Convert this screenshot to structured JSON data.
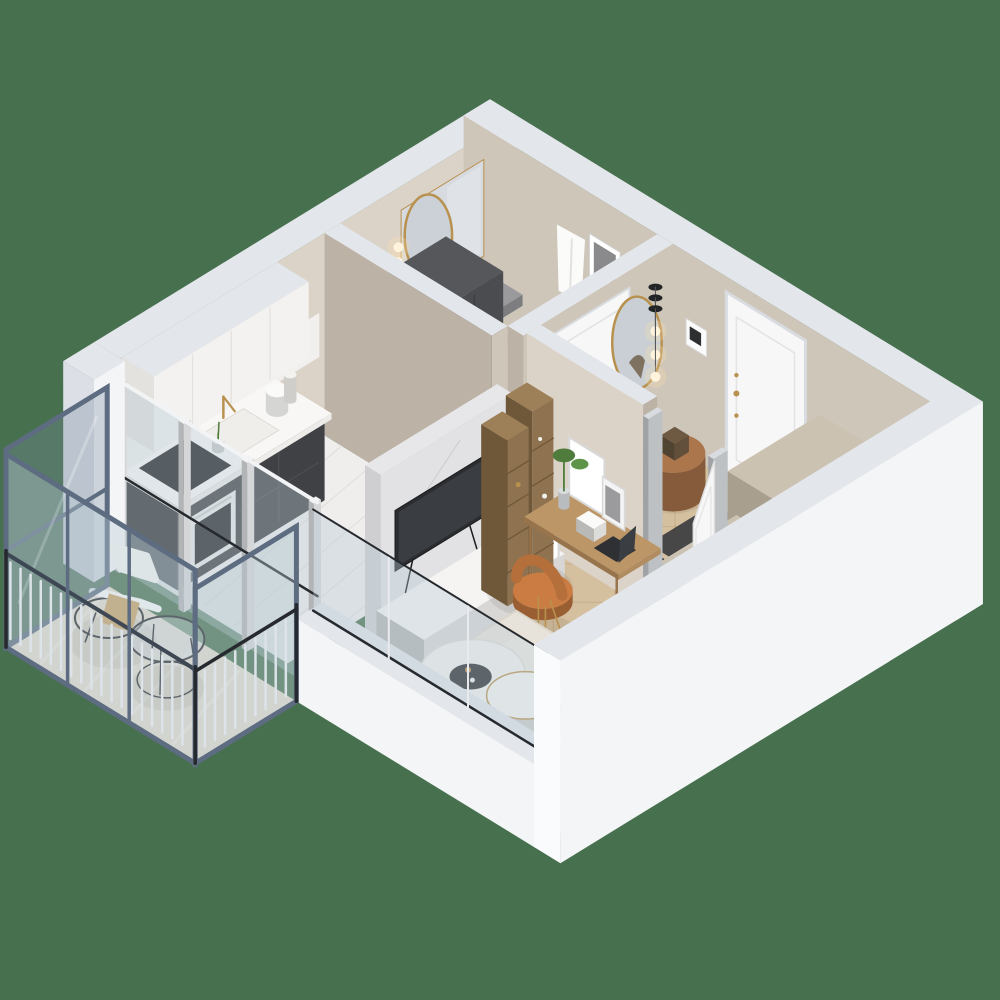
{
  "scene": {
    "type": "isometric-3d-floor-plan-render",
    "view": "axonometric-cutaway",
    "background_color": "#47714E",
    "palette": {
      "background": "#47714E",
      "outer_wall": "#F4F5F7",
      "outer_wall_shade": "#DCE0E6",
      "wall_top": "#E3E6EB",
      "wall_top_shade": "#CDD2DA",
      "inner_wall": "#CFC6BA",
      "inner_wall_light": "#DBD3C8",
      "inner_wall_dark": "#BCB2A5",
      "floor_wood": "#D4BF9F",
      "floor_wood_line": "#BB9F74",
      "floor_marble": "#EFEEEC",
      "marble_vein": "#DCDAD7",
      "bath_floor": "#E8E7E5",
      "balcony_floor": "#E2DACC",
      "cabinet_white": "#F3F2F0",
      "cabinet_white_shade": "#E4E2DE",
      "counter_white": "#F8F7F5",
      "kitchen_dark": "#3F4145",
      "kitchen_dark_shade": "#2F3134",
      "cooktop_black": "#1A1B1D",
      "oven_black": "#242628",
      "tall_cabinet": "#4A4C50",
      "tall_cabinet_shade": "#393B3F",
      "gold": "#B8914F",
      "marble_wall": "#DEDEE0",
      "tv_black": "#2B2D30",
      "bench_white": "#F5F4F2",
      "wood_shelf": "#8F7350",
      "wood_shelf_dark": "#6F5839",
      "desk_wood": "#B08C60",
      "desk_wood_dark": "#97744C",
      "chair_cognac": "#B46F3B",
      "door_white": "#F7F7F7",
      "door_shade": "#E9E9EA",
      "frame_gray": "#D8DBDF",
      "wardrobe_beige": "#C0B7A8",
      "wardrobe_beige_shade": "#A99F8F",
      "rug": "#E8E3DA",
      "rug_shade": "#DCD6CB",
      "sofa_cream": "#F0EBE1",
      "pillow_tan": "#C38D58",
      "pillow_brown": "#A66B3C",
      "pillow_gray": "#B9B1A7",
      "pillow_cream": "#E9E0D2",
      "pouf_brown": "#9C6B45",
      "mat_dark": "#3C3D3F",
      "balcony_frame": "#5D6C80",
      "balcony_frame_dark": "#3E4754",
      "rail_white": "#F2F3F5",
      "glass": "rgba(185,202,214,0.38)",
      "glass_dark": "rgba(120,140,160,0.32)",
      "plant_green": "#4F7C3C",
      "glow_warm": "#FFDFA8",
      "metal_black": "#26292D",
      "mirror_glass": "#D7DBDF",
      "gray_counter": "#8E8E90"
    },
    "rooms": [
      {
        "name": "bathroom",
        "furniture": [
          "vanity-counter",
          "vessel-basin",
          "gold-wall-faucet",
          "mirror-panel",
          "arched-gold-mirror",
          "wall-sconce",
          "tall-storage-cabinet",
          "bathtub",
          "hanging-towel",
          "framed-art",
          "gold-towel-ladder",
          "bathroom-door"
        ]
      },
      {
        "name": "kitchen",
        "furniture": [
          "upper-cabinets",
          "marble-backsplash",
          "countertop",
          "inset-sink",
          "gold-faucet",
          "induction-cooktop",
          "built-in-oven",
          "base-cabinets",
          "kettle",
          "paper-towel-roll",
          "flower-vase"
        ]
      },
      {
        "name": "hallway",
        "furniture": [
          "entrance-door",
          "intercom-panel",
          "oval-gold-mirror",
          "pendant-lights",
          "wooden-pouf",
          "handbag",
          "heeled-shoes",
          "doormat",
          "wardrobe-cabinet-large",
          "wardrobe-cabinet-small"
        ]
      },
      {
        "name": "living-room",
        "furniture": [
          "marble-tv-wall",
          "wall-mounted-tv",
          "media-bench",
          "leaning-picture-frame",
          "wooden-shelving-towers",
          "desk",
          "laptop",
          "desk-picture-frames",
          "desk-organizer",
          "desk-plant",
          "cognac-chair",
          "open-interior-door",
          "area-rug",
          "nesting-coffee-tables",
          "black-serving-tray",
          "gold-sphere-floor-lamp",
          "sofa",
          "sofa-cushions"
        ]
      },
      {
        "name": "balcony",
        "furniture": [
          "glazed-enclosure",
          "white-railing",
          "wire-lounge-chair",
          "seat-cushion",
          "tan-blanket",
          "wire-coffee-table",
          "glass-partition-door"
        ]
      }
    ],
    "structure": [
      "white-outer-walls",
      "greige-interior-partitions",
      "herringbone-wood-floor",
      "marble-kitchen-floor",
      "glazed-balcony-enclosure"
    ]
  }
}
